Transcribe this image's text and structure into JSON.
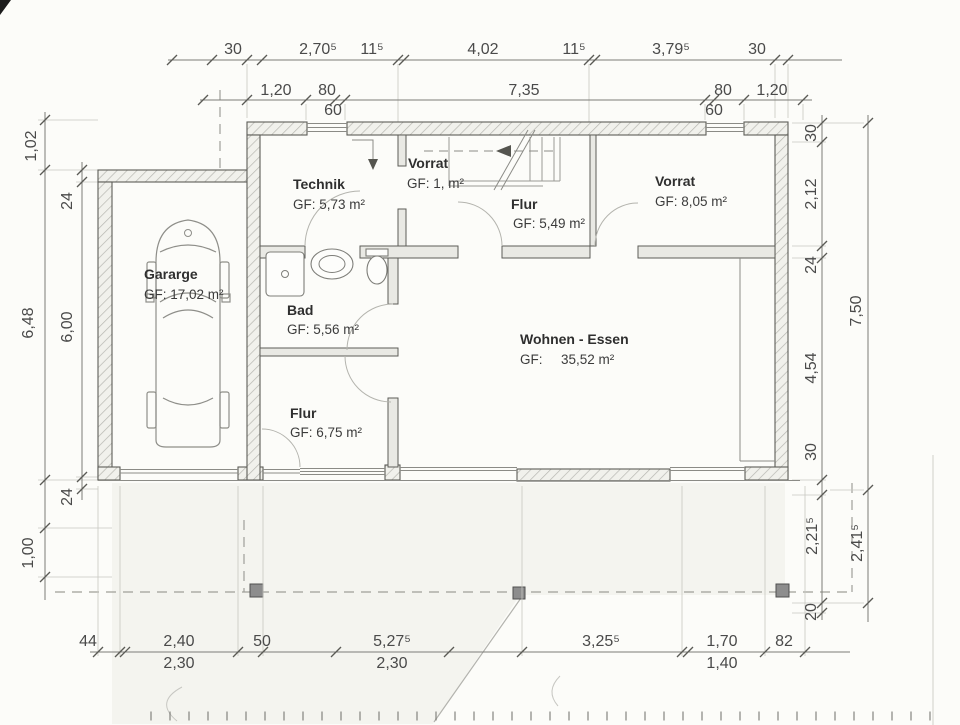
{
  "rooms": [
    {
      "name": "Technik",
      "area": "GF: 5,73 m²"
    },
    {
      "name": "Vorrat",
      "area": "GF: 1,  m²"
    },
    {
      "name": "Flur",
      "area": "GF: 5,49 m²"
    },
    {
      "name": "Vorrat",
      "area": "GF: 8,05 m²"
    },
    {
      "name": "Gararge",
      "area": "GF: 17,02 m²"
    },
    {
      "name": "Bad",
      "area": "GF: 5,56 m²"
    },
    {
      "name": "Wohnen - Essen",
      "area_label": "GF:",
      "area_value": "35,52 m²"
    },
    {
      "name": "Flur",
      "area": "GF: 6,75 m²"
    }
  ],
  "dims_top_row1": [
    "30",
    "2,70⁵",
    "11⁵",
    "4,02",
    "11⁵",
    "3,79⁵",
    "30"
  ],
  "dims_top_row2": [
    "1,20",
    "80",
    "7,35",
    "80",
    "1,20"
  ],
  "dims_top_row2_sub": [
    "60",
    "60"
  ],
  "dims_left_outer": [
    "1,02",
    "6,48",
    "1,00"
  ],
  "dims_left_inner": [
    "24",
    "6,00",
    "24"
  ],
  "dims_right_inner": [
    "30",
    "2,12",
    "24",
    "4,54",
    "30",
    "2,21⁵",
    "20"
  ],
  "dims_right_outer": [
    "7,50",
    "2,41⁵"
  ],
  "dims_bottom_row1": [
    "44",
    "2,40",
    "50",
    "5,27⁵",
    "3,25⁵",
    "1,70",
    "82"
  ],
  "dims_bottom_row2": [
    "2,30",
    "2,30",
    "1,40"
  ]
}
